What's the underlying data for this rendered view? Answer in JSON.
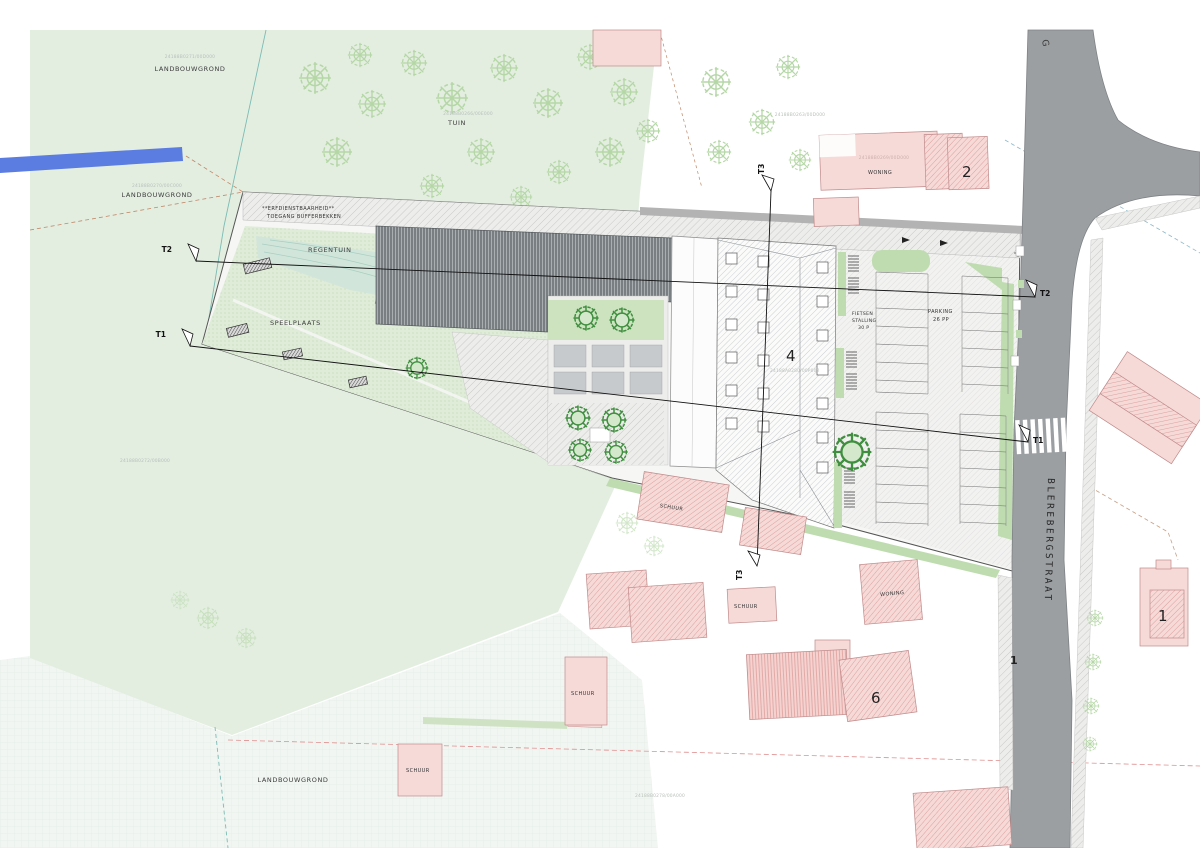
{
  "canvas": {
    "width": 1200,
    "height": 848
  },
  "areas": {
    "landbouwgrond_nw": {
      "label": "LANDBOUWGROND",
      "code": "24188B0271/00D000"
    },
    "landbouwgrond_w": {
      "label": "LANDBOUWGROND",
      "code": "24188B0270/00C000"
    },
    "landbouwgrond_s": {
      "label": "LANDBOUWGROND"
    },
    "tuin": {
      "label": "TUIN",
      "code": "24188B0266/00E000"
    },
    "code_ne": "24188B0263/00D000",
    "code_center": "24188A0280/00P002",
    "code_west": "24188B0272/00B000",
    "code_south": "24188B0278/00A000",
    "code_woning_north": "24188B0269/00D000"
  },
  "site": {
    "easement_line1": "**ERFDIENSTBAARHEID**",
    "easement_line2": "TOEGANG BUFFERBEKKEN",
    "regentuin_label": "REGENTUIN",
    "speelplaats_label": "SPEELPLAATS",
    "bike_line1": "FIETSEN",
    "bike_line2": "STALLING",
    "bike_line3": "30 P",
    "parking_line1": "PARKING",
    "parking_line2": "26 PP",
    "building_number": "4"
  },
  "buildings": {
    "woning_north": "WONING",
    "woning_north_number": "2",
    "woning_south": "WONING",
    "schuur_label": "SCHUUR",
    "south_number": "6",
    "southeast_number": "1"
  },
  "street": {
    "name": "BLEREBERGSTRAAT",
    "top_label": "G",
    "house_number": "1"
  },
  "sections": {
    "t1": "T1",
    "t2": "T2",
    "t3": "T3"
  },
  "colors": {
    "agri_green": "#e3eee1",
    "play_green": "#dfecd8",
    "road_gray": "#9b9fa2",
    "building_pink": "#f6dad8",
    "water_blue": "#5b7ce0",
    "accent_green": "#bfdcb0"
  }
}
